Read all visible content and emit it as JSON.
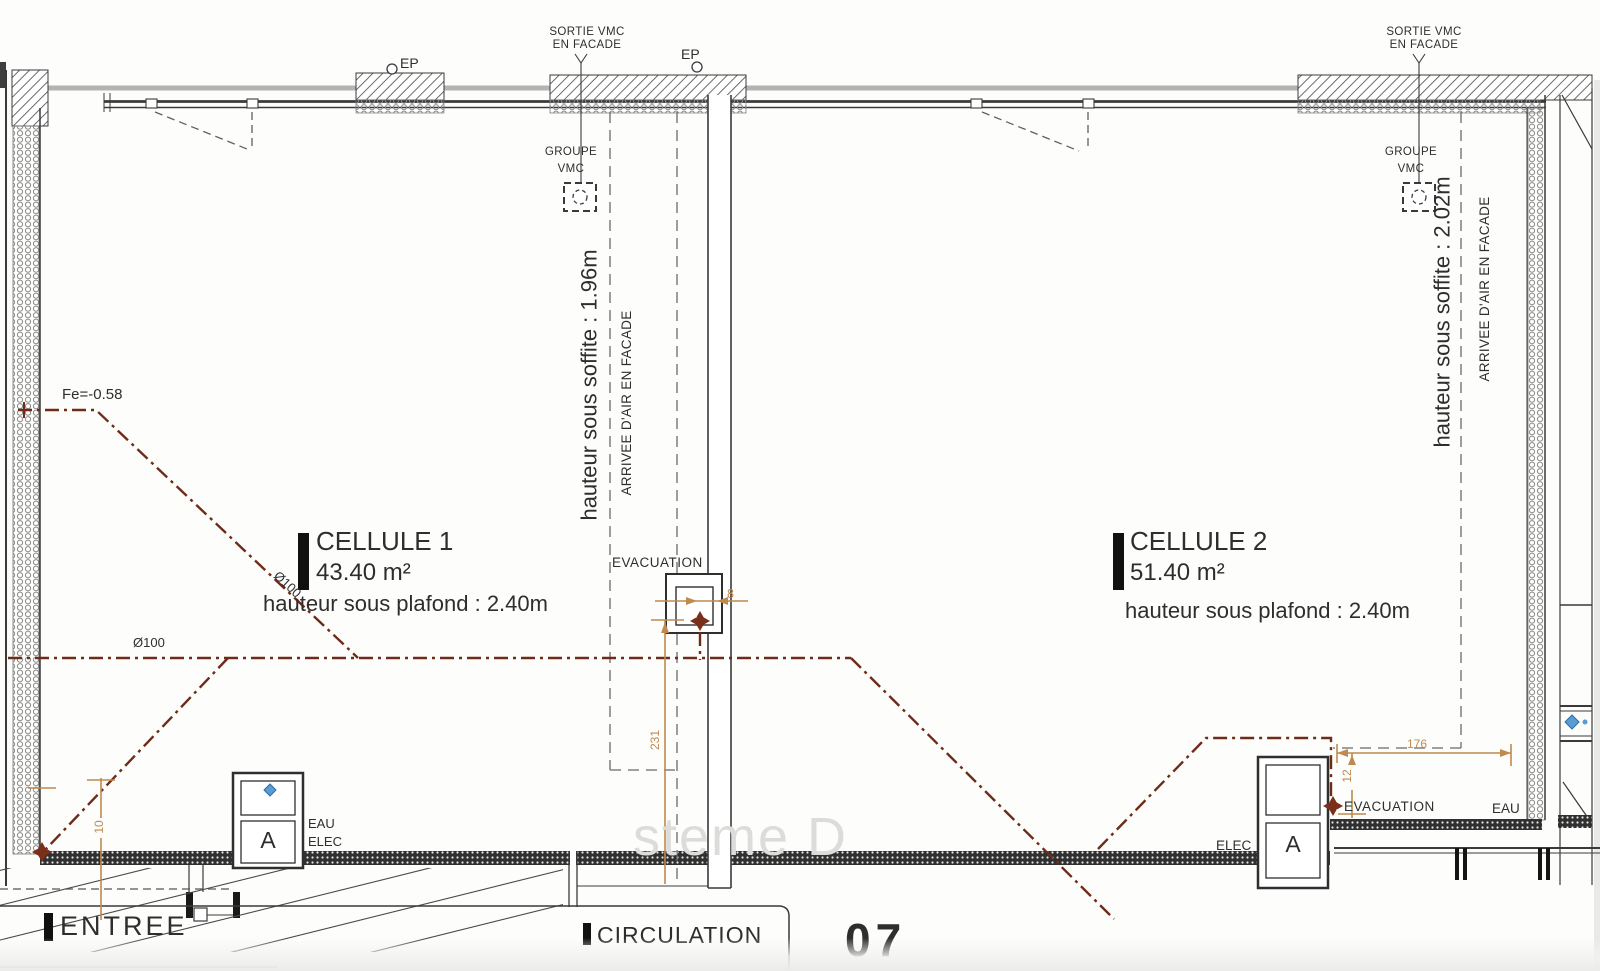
{
  "colors": {
    "line_dark": "#3a3a3a",
    "pipe_brown": "#6e2b18",
    "dim_orange": "#c08a4e",
    "fixture_blue": "#5b9bd5",
    "watermark_gray": "#dcdcda"
  },
  "facade": {
    "sortie_vmc_line1": "SORTIE VMC",
    "sortie_vmc_line2": "EN FACADE",
    "ep": "EP"
  },
  "vmc": {
    "groupe_line1": "GROUPE",
    "groupe_line2": "VMC"
  },
  "rooms": {
    "cell1": {
      "name": "CELLULE 1",
      "area": "43.40 m²",
      "ceiling_height": "hauteur sous plafond : 2.40m",
      "soffit_height": "hauteur sous soffite : 1.96m",
      "air_inlet": "ARRIVEE D'AIR EN FACADE"
    },
    "cell2": {
      "name": "CELLULE 2",
      "area": "51.40 m²",
      "ceiling_height": "hauteur sous plafond : 2.40m",
      "soffit_height": "hauteur sous soffite : 2.02m",
      "air_inlet": "ARRIVEE D'AIR EN FACADE"
    }
  },
  "annotations": {
    "fe_level": "Fe=-0.58",
    "pipe_diameter": "Ø100",
    "evacuation": "EVACUATION",
    "eau": "EAU",
    "elec": "ELEC",
    "cabinet": "A",
    "entree": "ENTREE",
    "circulation": "CIRCULATION",
    "plan_number": "07",
    "watermark": "steme D"
  },
  "dimensions": {
    "wall_thickness": "8",
    "duct_run": "231",
    "niche_width": "176",
    "niche_offset": "12",
    "left_offset": "10"
  },
  "symbols": {
    "vmc_unit": "dashed-square-with-circle",
    "pipe_valve": "brown-cross-valve-marker",
    "water_fixture": "blue-diamond",
    "rain_pipe": "small-circle"
  }
}
